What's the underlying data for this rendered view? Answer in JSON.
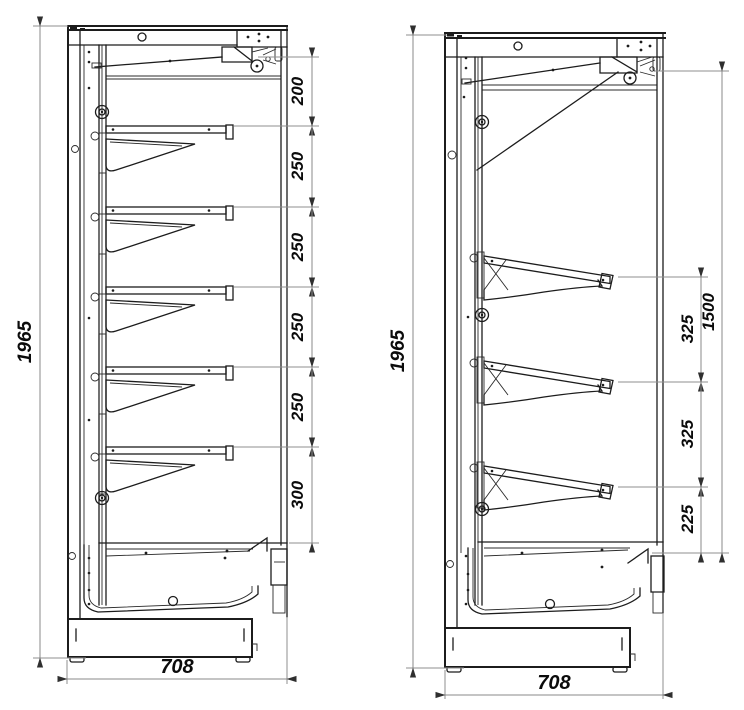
{
  "figure": {
    "type": "technical-drawing-cross-sections",
    "views": {
      "left": {
        "overall_height": "1965",
        "overall_depth": "708",
        "gaps": [
          "200",
          "250",
          "250",
          "250",
          "250",
          "300"
        ]
      },
      "right": {
        "overall_height": "1965",
        "overall_depth": "708",
        "gaps": [
          "325",
          "325",
          "225"
        ],
        "shelf_zone_height": "1500"
      }
    },
    "colors": {
      "line": "#1c1c1c",
      "dim_line": "#8a8a8a",
      "text": "#0b0b0b",
      "background": "#ffffff"
    }
  }
}
